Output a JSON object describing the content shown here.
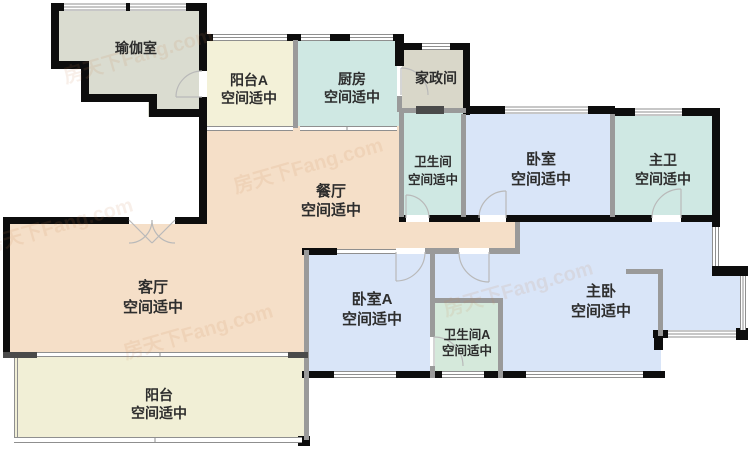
{
  "watermark_text": "房天下Fang.com",
  "colors": {
    "yoga": "#dadcd0",
    "balcony_a": "#f3f1d8",
    "kitchen": "#cfe8e3",
    "laundry": "#d9d7c9",
    "bathroom": "#cfe8e3",
    "bedroom": "#d9e5f8",
    "master_bath": "#cfe8e3",
    "dining_living": "#f5dfc8",
    "bedroom_a": "#d9e5f8",
    "bathroom_a": "#d5e9db",
    "master_bedroom": "#d9e5f8",
    "balcony": "#f1efd6",
    "label": "#2d2d2d",
    "watermark": "#c8834f"
  },
  "rooms": {
    "yoga": {
      "name": "瑜伽室"
    },
    "balcony_a": {
      "name": "阳台A",
      "subtitle": "空间适中"
    },
    "kitchen": {
      "name": "厨房",
      "subtitle": "空间适中"
    },
    "laundry": {
      "name": "家政间"
    },
    "bathroom": {
      "name": "卫生间",
      "subtitle": "空间适中"
    },
    "bedroom": {
      "name": "卧室",
      "subtitle": "空间适中"
    },
    "master_bath": {
      "name": "主卫",
      "subtitle": "空间适中"
    },
    "dining": {
      "name": "餐厅",
      "subtitle": "空间适中"
    },
    "living": {
      "name": "客厅",
      "subtitle": "空间适中"
    },
    "bedroom_a": {
      "name": "卧室A",
      "subtitle": "空间适中"
    },
    "bathroom_a": {
      "name": "卫生间A",
      "subtitle": "空间适中"
    },
    "master_bedroom": {
      "name": "主卧",
      "subtitle": "空间适中"
    },
    "balcony": {
      "name": "阳台",
      "subtitle": "空间适中"
    }
  }
}
